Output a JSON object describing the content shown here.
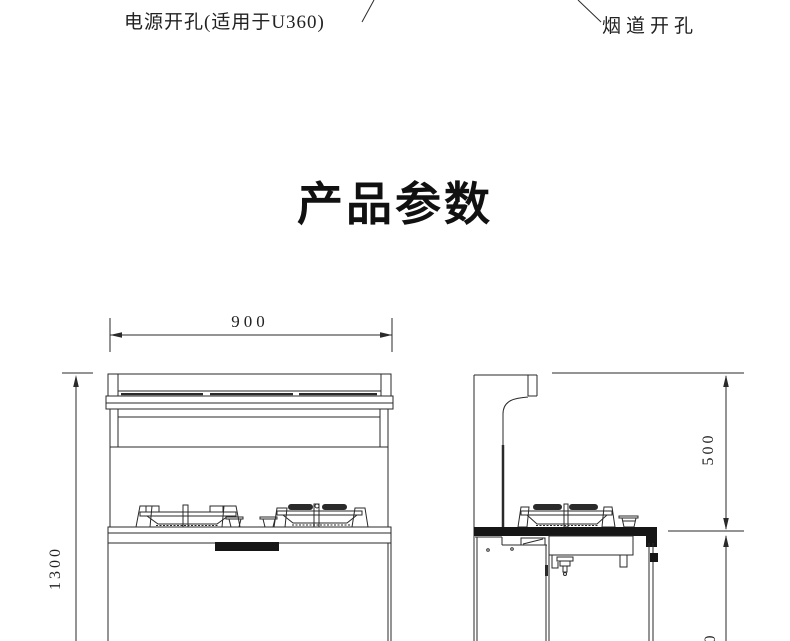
{
  "colors": {
    "background": "#ffffff",
    "line": "#2a2a2a",
    "ink": "#161616",
    "text": "#1a1a1a"
  },
  "annotations": {
    "power_hole_label": "电源开孔(适用于U360)",
    "flue_hole_label": "烟道开孔"
  },
  "title": "产品参数",
  "dimensions": {
    "front_width": "900",
    "front_height": "1300",
    "side_hood_to_counter": "500",
    "side_bottom_partial_digit": "0"
  },
  "drawing": {
    "type": "technical-elevation",
    "views": [
      {
        "name": "front-elevation",
        "features": [
          "hood-top-rail",
          "recessed-panel",
          "two-burner-cooktop",
          "black-handle",
          "cabinet-base"
        ]
      },
      {
        "name": "side-elevation",
        "features": [
          "flue-duct-stub",
          "curved-hood-profile",
          "burner",
          "black-countertop",
          "cabinet-base"
        ]
      }
    ]
  }
}
